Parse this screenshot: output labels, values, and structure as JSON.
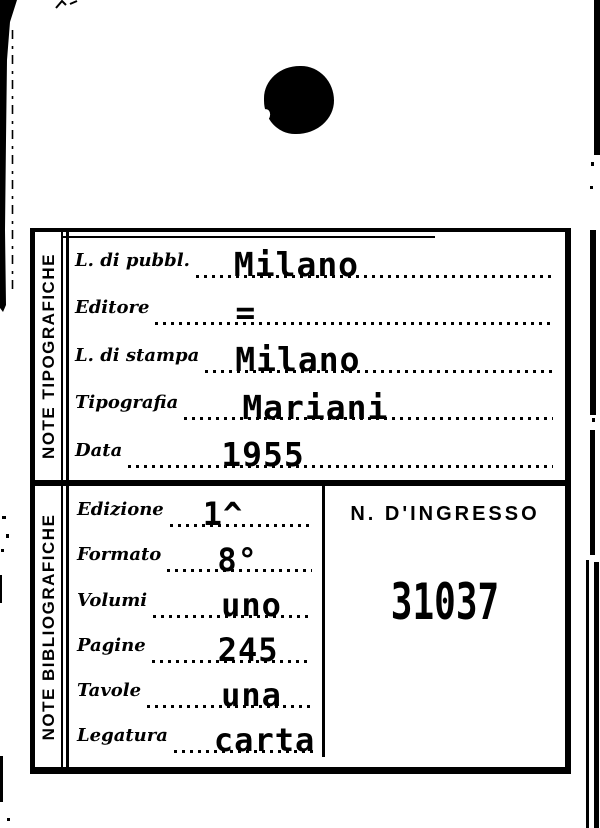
{
  "colors": {
    "ink": "#000000",
    "paper": "#ffffff"
  },
  "card": {
    "sections": {
      "tipografiche": {
        "side_label": "NOTE TIPOGRAFICHE",
        "fields": [
          {
            "label": "L. di pubbl.",
            "value": "Milano"
          },
          {
            "label": "Editore",
            "value": "="
          },
          {
            "label": "L. di stampa",
            "value": "Milano"
          },
          {
            "label": "Tipografia",
            "value": "Mariani"
          },
          {
            "label": "Data",
            "value": "1955"
          }
        ]
      },
      "bibliografiche": {
        "side_label": "NOTE BIBLIOGRAFICHE",
        "fields": [
          {
            "label": "Edizione",
            "value": "1^"
          },
          {
            "label": "Formato",
            "value": "8°"
          },
          {
            "label": "Volumi",
            "value": "uno"
          },
          {
            "label": "Pagine",
            "value": "245"
          },
          {
            "label": "Tavole",
            "value": "una"
          },
          {
            "label": "Legatura",
            "value": "carta"
          }
        ]
      },
      "ingresso": {
        "label": "N. D'INGRESSO",
        "number": "31037"
      }
    }
  }
}
